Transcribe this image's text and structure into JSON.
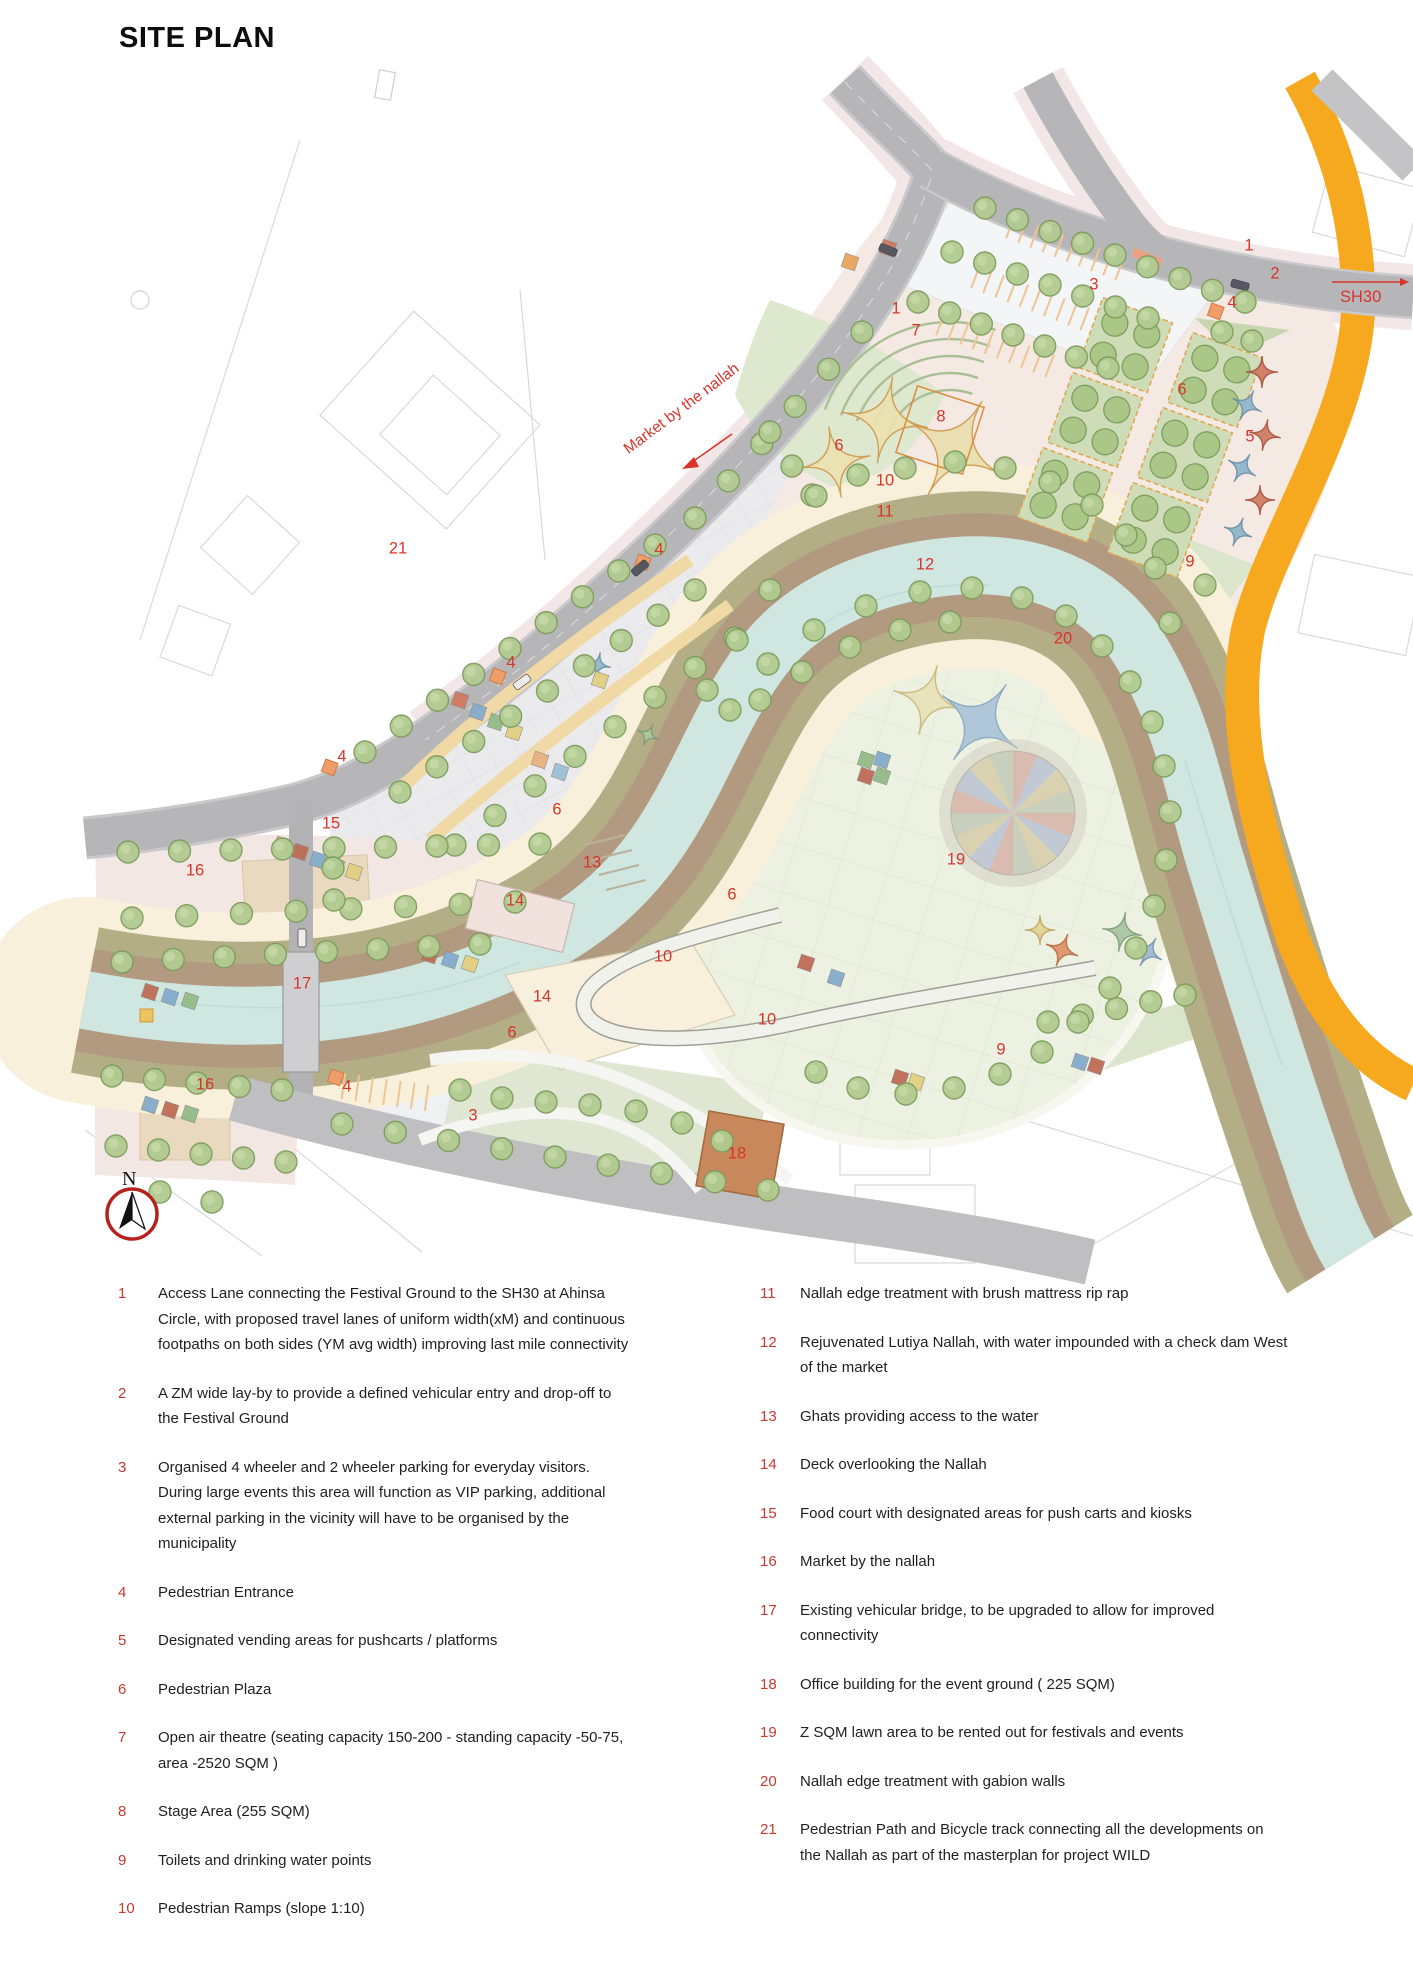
{
  "title": "SITE PLAN",
  "compass": {
    "label": "N"
  },
  "map": {
    "sh30_label": "SH30",
    "market_label": "Market by the nallah",
    "markers": [
      {
        "n": "1",
        "x": 896,
        "y": 309
      },
      {
        "n": "1",
        "x": 1249,
        "y": 246
      },
      {
        "n": "2",
        "x": 1275,
        "y": 274
      },
      {
        "n": "3",
        "x": 1094,
        "y": 285
      },
      {
        "n": "3",
        "x": 473,
        "y": 1116
      },
      {
        "n": "4",
        "x": 1232,
        "y": 303
      },
      {
        "n": "4",
        "x": 659,
        "y": 550
      },
      {
        "n": "4",
        "x": 511,
        "y": 663
      },
      {
        "n": "4",
        "x": 342,
        "y": 757
      },
      {
        "n": "4",
        "x": 347,
        "y": 1087
      },
      {
        "n": "5",
        "x": 1250,
        "y": 437
      },
      {
        "n": "6",
        "x": 1182,
        "y": 390
      },
      {
        "n": "6",
        "x": 839,
        "y": 446
      },
      {
        "n": "6",
        "x": 557,
        "y": 810
      },
      {
        "n": "6",
        "x": 732,
        "y": 895
      },
      {
        "n": "6",
        "x": 512,
        "y": 1033
      },
      {
        "n": "7",
        "x": 916,
        "y": 331
      },
      {
        "n": "8",
        "x": 941,
        "y": 417
      },
      {
        "n": "9",
        "x": 1190,
        "y": 562
      },
      {
        "n": "9",
        "x": 1001,
        "y": 1050
      },
      {
        "n": "10",
        "x": 885,
        "y": 481
      },
      {
        "n": "10",
        "x": 663,
        "y": 957
      },
      {
        "n": "10",
        "x": 767,
        "y": 1020
      },
      {
        "n": "11",
        "x": 885,
        "y": 512
      },
      {
        "n": "12",
        "x": 925,
        "y": 565
      },
      {
        "n": "13",
        "x": 592,
        "y": 863
      },
      {
        "n": "14",
        "x": 515,
        "y": 901
      },
      {
        "n": "14",
        "x": 542,
        "y": 997
      },
      {
        "n": "15",
        "x": 331,
        "y": 824
      },
      {
        "n": "16",
        "x": 195,
        "y": 871
      },
      {
        "n": "16",
        "x": 205,
        "y": 1085
      },
      {
        "n": "17",
        "x": 302,
        "y": 984
      },
      {
        "n": "18",
        "x": 737,
        "y": 1154
      },
      {
        "n": "19",
        "x": 956,
        "y": 860
      },
      {
        "n": "20",
        "x": 1063,
        "y": 639
      },
      {
        "n": "21",
        "x": 398,
        "y": 549
      }
    ]
  },
  "legend": {
    "left": [
      {
        "num": "1",
        "text": "Access Lane connecting the Festival Ground to the SH30 at Ahinsa  Circle, with proposed travel lanes of uniform width(xM) and continuous footpaths on both sides (YM avg width) improving last mile connectivity"
      },
      {
        "num": "2",
        "text": "A ZM wide lay-by to provide a defined vehicular entry and drop-off to the Festival Ground"
      },
      {
        "num": "3",
        "text": "Organised 4 wheeler and 2 wheeler parking for everyday visitors. During large events this area will function as VIP parking, additional external parking in the vicinity will have to be organised by the municipality"
      },
      {
        "num": "4",
        "text": "Pedestrian Entrance"
      },
      {
        "num": "5",
        "text": "Designated vending areas for pushcarts / platforms"
      },
      {
        "num": "6",
        "text": "Pedestrian Plaza"
      },
      {
        "num": "7",
        "text": "Open air theatre (seating capacity 150-200 - standing capacity -50-75, area -2520 SQM  )"
      },
      {
        "num": "8",
        "text": "Stage Area (255 SQM)"
      },
      {
        "num": "9",
        "text": "Toilets and drinking water points"
      },
      {
        "num": "10",
        "text": "Pedestrian Ramps (slope 1:10)"
      }
    ],
    "right": [
      {
        "num": "11",
        "text": "Nallah edge treatment with brush mattress rip rap"
      },
      {
        "num": "12",
        "text": "Rejuvenated Lutiya Nallah, with water impounded with a check dam West of the market"
      },
      {
        "num": "13",
        "text": "Ghats providing access to the water"
      },
      {
        "num": "14",
        "text": "Deck overlooking the Nallah"
      },
      {
        "num": "15",
        "text": "Food court with designated areas for push carts and kiosks"
      },
      {
        "num": "16",
        "text": "Market by the nallah"
      },
      {
        "num": "17",
        "text": "Existing vehicular bridge, to be upgraded to allow for improved connectivity"
      },
      {
        "num": "18",
        "text": "Office building for the event ground ( 225 SQM)"
      },
      {
        "num": "19",
        "text": "Z SQM lawn area to be rented out for festivals and events"
      },
      {
        "num": "20",
        "text": "Nallah edge treatment with gabion walls"
      },
      {
        "num": "21",
        "text": "Pedestrian Path and Bicycle track connecting all the developments on the Nallah as part of the masterplan for project WILD"
      }
    ]
  }
}
